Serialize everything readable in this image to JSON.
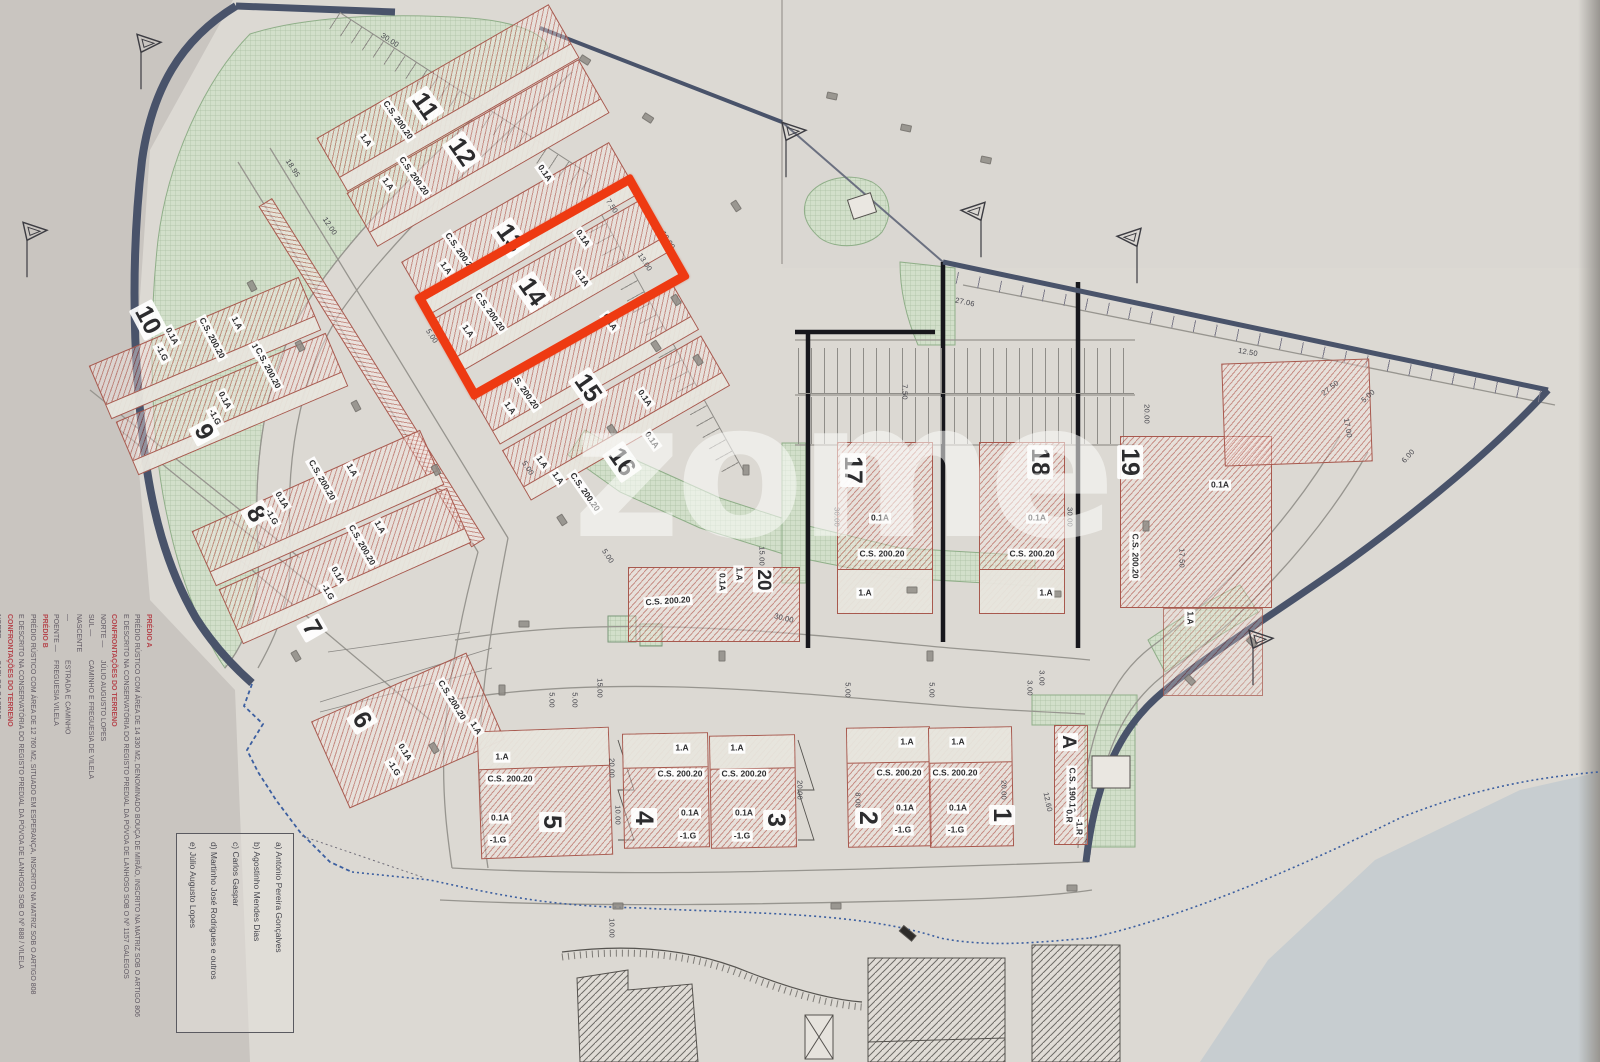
{
  "document": {
    "kind": "allotment site plan (scanned)",
    "highlighted_lot": "14"
  },
  "watermark": "zome",
  "colors": {
    "highlight_red": "#ee3a12",
    "lot_hatch": "#b2483c",
    "green_area": "#cfdcc8",
    "navy_boundary": "#4a546c",
    "dashed_boundary_blue": "#3c5fa0",
    "paper": "#dcd9d3"
  },
  "title_block": {
    "predio_a": {
      "header": "PRÉDIO A",
      "line1": "PRÉDIO RÚSTICO COM ÁREA DE 14 330 M2, DENOMINADO BOUÇA DE MIRÃO, INSCRITO NA MATRIZ SOB O ARTIGO 806",
      "line2": "E DESCRITO NA CONSERVATÓRIA DO REGISTO PREDIAL DA PÓVOA DE LANHOSO SOB O Nº 1157 GALEGOS",
      "confront": "CONFRONTAÇÕES DO TERRENO",
      "rows": [
        {
          "k": "NORTE —",
          "v": "JÚLIO AUGUSTO LOPES"
        },
        {
          "k": "SUL —",
          "v": "CAMINHO E FREGUESIA DE VILELA"
        },
        {
          "k": "NASCENTE —",
          "v": "ESTRADA E CAMINHO"
        },
        {
          "k": "POENTE —",
          "v": "FREGUESIA VILELA"
        }
      ]
    },
    "predio_b": {
      "header": "PRÉDIO B",
      "line1": "PRÉDIO RÚSTICO COM ÁREA DE 12 760 M2, SITUADO EM ESPERANÇA, INSCRITO NA MATRIZ SOB O ARTIGO 808",
      "line2": "E DESCRITO NA CONSERVATÓRIA DO REGISTO PREDIAL DA PÓVOA DE LANHOSO SOB O Nº 888 / VILELA",
      "confront": "CONFRONTAÇÕES DO TERRENO",
      "rows": [
        {
          "k": "NORTE —",
          "v": "CARLOS GASPAR"
        },
        {
          "k": "SUL —",
          "v": ""
        }
      ]
    }
  },
  "owners_box": {
    "items": [
      "a) António Pereira Gonçalves",
      "b) Agostinho Mendes Dias",
      "c) Carlos Gaspar",
      "d) Martinho José Rodrigues e outros",
      "e) Júlio Augusto Lopes"
    ]
  },
  "lots": [
    {
      "id": "11",
      "cx": 448,
      "cy": 98,
      "w": 268,
      "h": 62,
      "r": -30,
      "yard": "b"
    },
    {
      "id": "12",
      "cx": 478,
      "cy": 153,
      "w": 268,
      "h": 62,
      "r": -30,
      "yard": "b"
    },
    {
      "id": "13",
      "cx": 520,
      "cy": 228,
      "w": 240,
      "h": 60,
      "r": -30,
      "yard": "b"
    },
    {
      "id": "14",
      "cx": 552,
      "cy": 285,
      "w": 240,
      "h": 60,
      "r": -30,
      "yard": "b"
    },
    {
      "id": "15",
      "cx": 585,
      "cy": 362,
      "w": 230,
      "h": 58,
      "r": -30,
      "yard": "b"
    },
    {
      "id": "16",
      "cx": 616,
      "cy": 418,
      "w": 230,
      "h": 58,
      "r": -30,
      "yard": "b"
    },
    {
      "id": "10",
      "cx": 205,
      "cy": 348,
      "w": 228,
      "h": 58,
      "r": -23,
      "yard": "b"
    },
    {
      "id": "9",
      "cx": 232,
      "cy": 404,
      "w": 228,
      "h": 58,
      "r": -23,
      "yard": "b"
    },
    {
      "id": "8",
      "cx": 318,
      "cy": 508,
      "w": 250,
      "h": 60,
      "r": -24,
      "yard": "b"
    },
    {
      "id": "7",
      "cx": 345,
      "cy": 566,
      "w": 250,
      "h": 60,
      "r": -24,
      "yard": "b"
    },
    {
      "id": "6",
      "cx": 408,
      "cy": 730,
      "w": 170,
      "h": 95,
      "r": -24,
      "yard": null
    },
    {
      "id": "5",
      "cx": 545,
      "cy": 793,
      "w": 132,
      "h": 128,
      "r": -2,
      "yard": "t"
    },
    {
      "id": "4",
      "cx": 666,
      "cy": 790,
      "w": 86,
      "h": 115,
      "r": -1,
      "yard": "t"
    },
    {
      "id": "3",
      "cx": 753,
      "cy": 791,
      "w": 86,
      "h": 113,
      "r": -1,
      "yard": "t"
    },
    {
      "id": "2",
      "cx": 889,
      "cy": 787,
      "w": 84,
      "h": 120,
      "r": -1,
      "yard": "t"
    },
    {
      "id": "1",
      "cx": 971,
      "cy": 787,
      "w": 84,
      "h": 120,
      "r": -1,
      "yard": "t"
    },
    {
      "id": "17",
      "cx": 885,
      "cy": 528,
      "w": 96,
      "h": 172,
      "r": 0,
      "yard": "b"
    },
    {
      "id": "18",
      "cx": 1022,
      "cy": 528,
      "w": 86,
      "h": 172,
      "r": 0,
      "yard": "b"
    },
    {
      "id": "19",
      "cx": 1196,
      "cy": 522,
      "w": 152,
      "h": 172,
      "r": 0,
      "yard": null
    },
    {
      "id": "19b",
      "cx": 1297,
      "cy": 412,
      "w": 148,
      "h": 103,
      "r": -2,
      "yard": null
    },
    {
      "id": "19c",
      "cx": 1213,
      "cy": 652,
      "w": 100,
      "h": 88,
      "r": 0,
      "yard": null,
      "lt": true
    },
    {
      "id": "20",
      "cx": 714,
      "cy": 604,
      "w": 172,
      "h": 75,
      "r": 0,
      "yard": null
    },
    {
      "id": "A",
      "cx": 1071,
      "cy": 785,
      "w": 34,
      "h": 120,
      "r": 0,
      "yard": null
    }
  ],
  "lot_labels": [
    [
      "11",
      425,
      106,
      55,
      "num"
    ],
    [
      "12",
      462,
      152,
      55,
      "num"
    ],
    [
      "13",
      510,
      238,
      55,
      "num"
    ],
    [
      "14",
      532,
      292,
      55,
      "num"
    ],
    [
      "15",
      588,
      388,
      55,
      "num"
    ],
    [
      "16",
      622,
      462,
      55,
      "num"
    ],
    [
      "10",
      148,
      320,
      62,
      "num"
    ],
    [
      "9",
      204,
      432,
      62,
      "num"
    ],
    [
      "8",
      256,
      514,
      60,
      "num"
    ],
    [
      "7",
      312,
      628,
      60,
      "num"
    ],
    [
      "6",
      362,
      720,
      58,
      "num"
    ],
    [
      "5",
      552,
      822,
      90,
      "num"
    ],
    [
      "4",
      644,
      818,
      90,
      "num"
    ],
    [
      "3",
      776,
      820,
      90,
      "num"
    ],
    [
      "2",
      868,
      818,
      90,
      "num"
    ],
    [
      "1",
      1002,
      815,
      90,
      "num"
    ],
    [
      "17",
      853,
      470,
      90,
      "num"
    ],
    [
      "18",
      1040,
      462,
      90,
      "num"
    ],
    [
      "19",
      1130,
      462,
      90,
      "num"
    ],
    [
      "20",
      763,
      580,
      90,
      "numsm"
    ],
    [
      "A",
      1068,
      742,
      90,
      "numsm"
    ],
    [
      "0.1A",
      545,
      173,
      55,
      "chip"
    ],
    [
      "C.S. 200.20",
      398,
      120,
      55,
      "chip"
    ],
    [
      "1.A",
      366,
      140,
      55,
      "chip"
    ],
    [
      "0.1A",
      583,
      238,
      55,
      "chip"
    ],
    [
      "C.S. 200.20",
      414,
      176,
      55,
      "chip"
    ],
    [
      "1.A",
      388,
      184,
      55,
      "chip"
    ],
    [
      "0.1A",
      582,
      278,
      55,
      "chip"
    ],
    [
      "C.S. 200.20",
      460,
      252,
      55,
      "chip"
    ],
    [
      "1.A",
      446,
      268,
      55,
      "chip"
    ],
    [
      "0.1A",
      610,
      322,
      55,
      "chip"
    ],
    [
      "C.S. 200.20",
      490,
      312,
      55,
      "chip"
    ],
    [
      "1.A",
      468,
      331,
      55,
      "chip"
    ],
    [
      "0.1A",
      645,
      398,
      55,
      "chip"
    ],
    [
      "C.S. 200.20",
      524,
      390,
      55,
      "chip"
    ],
    [
      "1.A",
      510,
      408,
      55,
      "chip"
    ],
    [
      "0.1A",
      652,
      440,
      55,
      "chip"
    ],
    [
      "1.A",
      542,
      462,
      55,
      "chip"
    ],
    [
      "1.A",
      558,
      478,
      55,
      "chip"
    ],
    [
      "C.S. 200.20",
      585,
      492,
      55,
      "chip"
    ],
    [
      "0.1A",
      172,
      336,
      62,
      "chip"
    ],
    [
      "-1.G",
      162,
      353,
      62,
      "chip"
    ],
    [
      "C.S. 200.20",
      212,
      338,
      62,
      "chip"
    ],
    [
      "1.A",
      237,
      323,
      62,
      "chip"
    ],
    [
      "1.A",
      257,
      350,
      62,
      "chip"
    ],
    [
      "C.S. 200.20",
      268,
      368,
      62,
      "chip"
    ],
    [
      "0.1A",
      225,
      400,
      62,
      "chip"
    ],
    [
      "-1.G",
      215,
      417,
      62,
      "chip"
    ],
    [
      "0.1A",
      282,
      500,
      60,
      "chip"
    ],
    [
      "-1.G",
      272,
      517,
      60,
      "chip"
    ],
    [
      "C.S. 200.20",
      322,
      480,
      60,
      "chip"
    ],
    [
      "1.A",
      352,
      470,
      60,
      "chip"
    ],
    [
      "0.1A",
      338,
      575,
      60,
      "chip"
    ],
    [
      "-1.G",
      328,
      592,
      60,
      "chip"
    ],
    [
      "C.S. 200.20",
      362,
      545,
      60,
      "chip"
    ],
    [
      "1.A",
      380,
      527,
      60,
      "chip"
    ],
    [
      "0.1A",
      405,
      752,
      58,
      "chip"
    ],
    [
      "-1.G",
      394,
      768,
      58,
      "chip"
    ],
    [
      "C.S. 200.20",
      452,
      700,
      58,
      "chip"
    ],
    [
      "1.A",
      476,
      728,
      58,
      "chip"
    ],
    [
      "1.A",
      502,
      757,
      0,
      "chip"
    ],
    [
      "C.S. 200.20",
      510,
      779,
      0,
      "chip"
    ],
    [
      "0.1A",
      500,
      818,
      0,
      "chip"
    ],
    [
      "-1.G",
      498,
      840,
      0,
      "chip"
    ],
    [
      "1.A",
      682,
      748,
      0,
      "chip"
    ],
    [
      "C.S. 200.20",
      680,
      774,
      0,
      "chip"
    ],
    [
      "0.1A",
      690,
      813,
      0,
      "chip"
    ],
    [
      "-1.G",
      688,
      836,
      0,
      "chip"
    ],
    [
      "1.A",
      737,
      748,
      0,
      "chip"
    ],
    [
      "C.S. 200.20",
      744,
      774,
      0,
      "chip"
    ],
    [
      "0.1A",
      744,
      813,
      0,
      "chip"
    ],
    [
      "-1.G",
      742,
      836,
      0,
      "chip"
    ],
    [
      "1.A",
      907,
      742,
      0,
      "chip"
    ],
    [
      "C.S. 200.20",
      899,
      773,
      0,
      "chip"
    ],
    [
      "0.1A",
      905,
      808,
      0,
      "chip"
    ],
    [
      "-1.G",
      903,
      830,
      0,
      "chip"
    ],
    [
      "1.A",
      958,
      742,
      0,
      "chip"
    ],
    [
      "C.S. 200.20",
      955,
      773,
      0,
      "chip"
    ],
    [
      "0.1A",
      958,
      808,
      0,
      "chip"
    ],
    [
      "-1.G",
      956,
      830,
      0,
      "chip"
    ],
    [
      "0.1A",
      880,
      518,
      0,
      "chip"
    ],
    [
      "C.S. 200.20",
      882,
      554,
      0,
      "chip"
    ],
    [
      "1.A",
      865,
      593,
      0,
      "chip"
    ],
    [
      "0.1A",
      1037,
      518,
      0,
      "chip"
    ],
    [
      "C.S. 200.20",
      1032,
      554,
      0,
      "chip"
    ],
    [
      "1.A",
      1046,
      593,
      0,
      "chip"
    ],
    [
      "0.1A",
      1220,
      485,
      0,
      "chip"
    ],
    [
      "C.S. 200.20",
      1135,
      556,
      90,
      "chip"
    ],
    [
      "1.A",
      1190,
      618,
      90,
      "chip"
    ],
    [
      "1.A",
      739,
      574,
      90,
      "chip"
    ],
    [
      "0.1A",
      722,
      582,
      90,
      "chip"
    ],
    [
      "C.S. 200.20",
      668,
      601,
      -4,
      "chip"
    ],
    [
      "C.S. 190.10",
      1072,
      790,
      90,
      "chip"
    ],
    [
      "0.R",
      1069,
      816,
      90,
      "chip"
    ],
    [
      "-1.R",
      1079,
      827,
      90,
      "chip"
    ]
  ],
  "dimensions": [
    [
      "30.00",
      390,
      40,
      33
    ],
    [
      "18.95",
      293,
      168,
      57
    ],
    [
      "12.00",
      330,
      226,
      57
    ],
    [
      "7.50",
      612,
      206,
      57
    ],
    [
      "10.00",
      668,
      240,
      57
    ],
    [
      "13.00",
      645,
      262,
      57
    ],
    [
      "5.00",
      432,
      336,
      57
    ],
    [
      "5.00",
      528,
      468,
      57
    ],
    [
      "5.00",
      608,
      556,
      57
    ],
    [
      "30.00",
      837,
      517,
      90
    ],
    [
      "30.00",
      1070,
      517,
      90
    ],
    [
      "7.50",
      905,
      392,
      90
    ],
    [
      "20.00",
      1147,
      414,
      90
    ],
    [
      "5.00",
      848,
      690,
      90
    ],
    [
      "5.00",
      932,
      690,
      90
    ],
    [
      "3.00",
      1030,
      688,
      90
    ],
    [
      "15.00",
      600,
      688,
      90
    ],
    [
      "20.00",
      612,
      768,
      90
    ],
    [
      "10.00",
      618,
      815,
      90
    ],
    [
      "20.00",
      800,
      790,
      90
    ],
    [
      "8.00",
      858,
      800,
      90
    ],
    [
      "20.00",
      1004,
      790,
      90
    ],
    [
      "12.60",
      1048,
      802,
      78
    ],
    [
      "17.00",
      1348,
      428,
      80
    ],
    [
      "5.00",
      1368,
      396,
      -42
    ],
    [
      "6.00",
      1408,
      456,
      -48
    ],
    [
      "12.50",
      1248,
      352,
      10
    ],
    [
      "27.50",
      1330,
      388,
      -38
    ],
    [
      "17.50",
      1182,
      558,
      90
    ],
    [
      "15.00",
      762,
      556,
      90
    ],
    [
      "30.00",
      784,
      618,
      14
    ],
    [
      "10.00",
      612,
      928,
      90
    ],
    [
      "5.00",
      552,
      700,
      90
    ],
    [
      "5.00",
      575,
      700,
      90
    ],
    [
      "3.00",
      1042,
      678,
      90
    ],
    [
      "27.06",
      965,
      302,
      12
    ]
  ],
  "flags": [
    {
      "x": 150,
      "y": 38,
      "m": 1
    },
    {
      "x": 36,
      "y": 226,
      "m": 1
    },
    {
      "x": 795,
      "y": 126,
      "m": 1
    },
    {
      "x": 972,
      "y": 206,
      "m": -1
    },
    {
      "x": 1128,
      "y": 232,
      "m": -1
    },
    {
      "x": 1262,
      "y": 634,
      "m": 1
    }
  ],
  "elevation_markers": [
    [
      585,
      60,
      33
    ],
    [
      648,
      118,
      33
    ],
    [
      736,
      206,
      57
    ],
    [
      676,
      300,
      57
    ],
    [
      656,
      346,
      57
    ],
    [
      612,
      430,
      57
    ],
    [
      562,
      520,
      57
    ],
    [
      436,
      470,
      62
    ],
    [
      356,
      406,
      62
    ],
    [
      300,
      346,
      62
    ],
    [
      252,
      286,
      62
    ],
    [
      524,
      624,
      0
    ],
    [
      434,
      748,
      58
    ],
    [
      296,
      656,
      60
    ],
    [
      832,
      96,
      12
    ],
    [
      906,
      128,
      12
    ],
    [
      986,
      160,
      12
    ],
    [
      746,
      470,
      90
    ],
    [
      912,
      590,
      0
    ],
    [
      1056,
      594,
      0
    ],
    [
      1146,
      526,
      90
    ],
    [
      930,
      656,
      90
    ],
    [
      722,
      656,
      90
    ],
    [
      502,
      690,
      90
    ],
    [
      618,
      906,
      0
    ],
    [
      836,
      906,
      0
    ],
    [
      1072,
      888,
      0
    ],
    [
      1190,
      680,
      45
    ],
    [
      1252,
      642,
      45
    ],
    [
      698,
      360,
      57
    ]
  ]
}
